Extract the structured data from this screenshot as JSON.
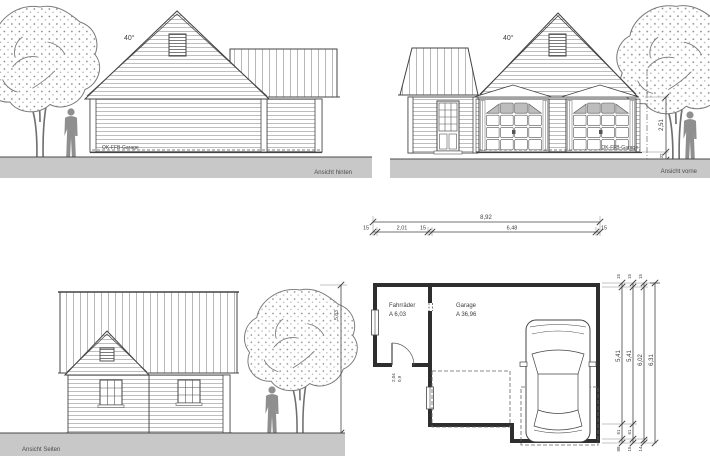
{
  "drawing": {
    "views": {
      "rear": {
        "label": "Ansicht hinten",
        "roof_angle": "40°",
        "floor_label": "OK-FFB-Garage"
      },
      "front": {
        "label": "Ansicht vorne",
        "roof_angle": "40°",
        "floor_label": "OK-FFB-Garage",
        "wall_height": "2,51",
        "plinth_height": "32"
      },
      "side": {
        "label": "Ansicht Seiten",
        "height_dim": "5,83"
      },
      "plan": {
        "rooms": [
          {
            "name": "Fahrräder",
            "area": "A 6,03"
          },
          {
            "name": "Garage",
            "area": "A 36,96"
          }
        ],
        "door": {
          "height": "2,04",
          "width": "0,9"
        },
        "dims_top": {
          "total": "8,92",
          "seg_wall_left": "15",
          "seg_room": "2,01",
          "seg_wall_mid": "15",
          "seg_garage": "6,48",
          "seg_wall_right": "15"
        },
        "dims_right": {
          "c1": {
            "top": "15",
            "main": "5,41",
            "b1": "61",
            "b2": "88"
          },
          "c2": {
            "top": "15",
            "main": "5,41",
            "b1": "61",
            "b2": "15"
          },
          "c3": {
            "top": "15",
            "main": "6,02",
            "b1": "14"
          },
          "c4": {
            "main": "6,31"
          }
        }
      }
    },
    "colors": {
      "ground": "#c8c8c8",
      "line": "#3e3e3e",
      "figure": "#8f8f8f",
      "window_glass": "#bdbdbd"
    }
  }
}
